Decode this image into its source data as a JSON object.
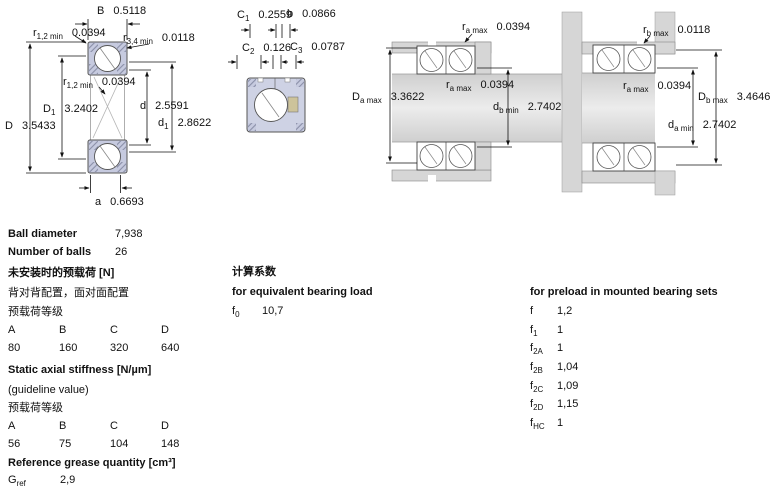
{
  "fig1": {
    "B": {
      "sym": "B",
      "sub": "",
      "val": "0.5118"
    },
    "r12_top": {
      "sym": "r",
      "sub": "1,2 min",
      "val": "0.0394"
    },
    "r34": {
      "sym": "r",
      "sub": "3,4 min",
      "val": "0.0118"
    },
    "r12_inner": {
      "sym": "r",
      "sub": "1,2 min",
      "val": "0.0394"
    },
    "D1": {
      "sym": "D",
      "sub": "1",
      "val": "3.2402"
    },
    "D": {
      "sym": "D",
      "sub": "",
      "val": "3.5433"
    },
    "d": {
      "sym": "d",
      "sub": "",
      "val": "2.5591"
    },
    "d1": {
      "sym": "d",
      "sub": "1",
      "val": "2.8622"
    },
    "a": {
      "sym": "a",
      "sub": "",
      "val": "0.6693"
    }
  },
  "fig2": {
    "C1": {
      "sym": "C",
      "sub": "1",
      "val": "0.2559"
    },
    "b": {
      "sym": "b",
      "sub": "",
      "val": "0.0866"
    },
    "C2": {
      "sym": "C",
      "sub": "2",
      "val": "0.126"
    },
    "C3": {
      "sym": "C",
      "sub": "3",
      "val": "0.0787"
    }
  },
  "fig3": {
    "ra_top": {
      "sym": "r",
      "sub": "a max",
      "val": "0.0394"
    },
    "Da_max": {
      "sym": "D",
      "sub": "a max",
      "val": "3.3622"
    },
    "ra_mid": {
      "sym": "r",
      "sub": "a max",
      "val": "0.0394"
    },
    "db_min": {
      "sym": "d",
      "sub": "b min",
      "val": "2.7402"
    }
  },
  "fig4": {
    "rb_max": {
      "sym": "r",
      "sub": "b max",
      "val": "0.0118"
    },
    "ra_max": {
      "sym": "r",
      "sub": "a max",
      "val": "0.0394"
    },
    "Db_max": {
      "sym": "D",
      "sub": "b max",
      "val": "3.4646"
    },
    "da_min": {
      "sym": "d",
      "sub": "a min",
      "val": "2.7402"
    }
  },
  "specs": {
    "ball_diameter_label": "Ball diameter",
    "ball_diameter": "7,938",
    "number_of_balls_label": "Number of balls",
    "number_of_balls": "26",
    "preload_header": "未安装时的预载荷 [N]",
    "arrangement_note": "背对背配置，面对面配置",
    "class_label_1": "预载荷等级",
    "classes": [
      "A",
      "B",
      "C",
      "D"
    ],
    "preload_values": [
      "80",
      "160",
      "320",
      "640"
    ],
    "stiffness_header": "Static axial stiffness [N/µm]",
    "stiffness_note": "(guideline value)",
    "class_label_2": "预载荷等级",
    "stiffness_values": [
      "56",
      "75",
      "104",
      "148"
    ],
    "grease_header": "Reference grease quantity [cm³]",
    "grease": {
      "sym": "G",
      "sub": "ref",
      "val": "2,9"
    }
  },
  "calc": {
    "header_cn": "计算系数",
    "equiv_header": "for equivalent bearing load",
    "f0": {
      "sym": "f",
      "sub": "0",
      "val": "10,7"
    }
  },
  "preload_factors": {
    "header": "for preload in mounted bearing sets",
    "rows": [
      {
        "sym": "f",
        "sub": "",
        "val": "1,2"
      },
      {
        "sym": "f",
        "sub": "1",
        "val": "1"
      },
      {
        "sym": "f",
        "sub": "2A",
        "val": "1"
      },
      {
        "sym": "f",
        "sub": "2B",
        "val": "1,04"
      },
      {
        "sym": "f",
        "sub": "2C",
        "val": "1,09"
      },
      {
        "sym": "f",
        "sub": "2D",
        "val": "1,15"
      },
      {
        "sym": "f",
        "sub": "HC",
        "val": "1"
      }
    ]
  },
  "colors": {
    "ring_lavender": "#c6cadf",
    "metal_gray": "#d6d6d6",
    "cage_khaki": "#cdc39b"
  }
}
